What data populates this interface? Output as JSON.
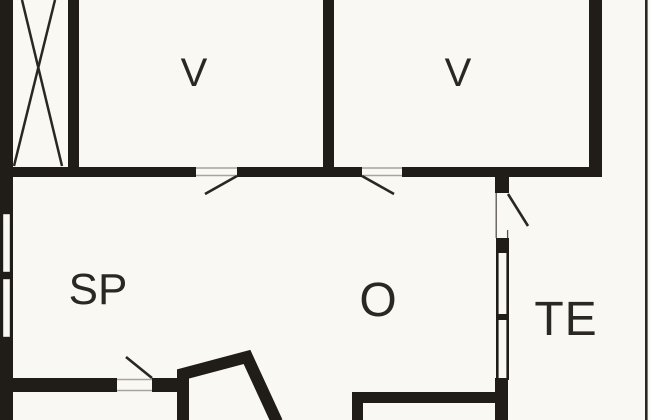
{
  "plan": {
    "type": "floor-plan",
    "colors": {
      "background": "#faf8f2",
      "wall": "#201d19",
      "label_text": "#2b2824",
      "door_swing": "#2a2723",
      "threshold": "#a8a49b"
    },
    "rooms": [
      {
        "id": "v1",
        "label": "V"
      },
      {
        "id": "v2",
        "label": "V"
      },
      {
        "id": "sp",
        "label": "SP"
      },
      {
        "id": "o",
        "label": "O"
      },
      {
        "id": "te",
        "label": "TE"
      }
    ],
    "features": {
      "shaft": "crossed-box",
      "doors": [
        "door-to-v1",
        "door-to-v2",
        "door-to-terrace",
        "door-sp-south"
      ],
      "windows": [
        "window-west-upper",
        "window-west-lower",
        "window-o-te-upper",
        "window-o-te-lower"
      ],
      "bay": "angled-bay-south",
      "terrace_edge": "thin-line-east"
    }
  }
}
